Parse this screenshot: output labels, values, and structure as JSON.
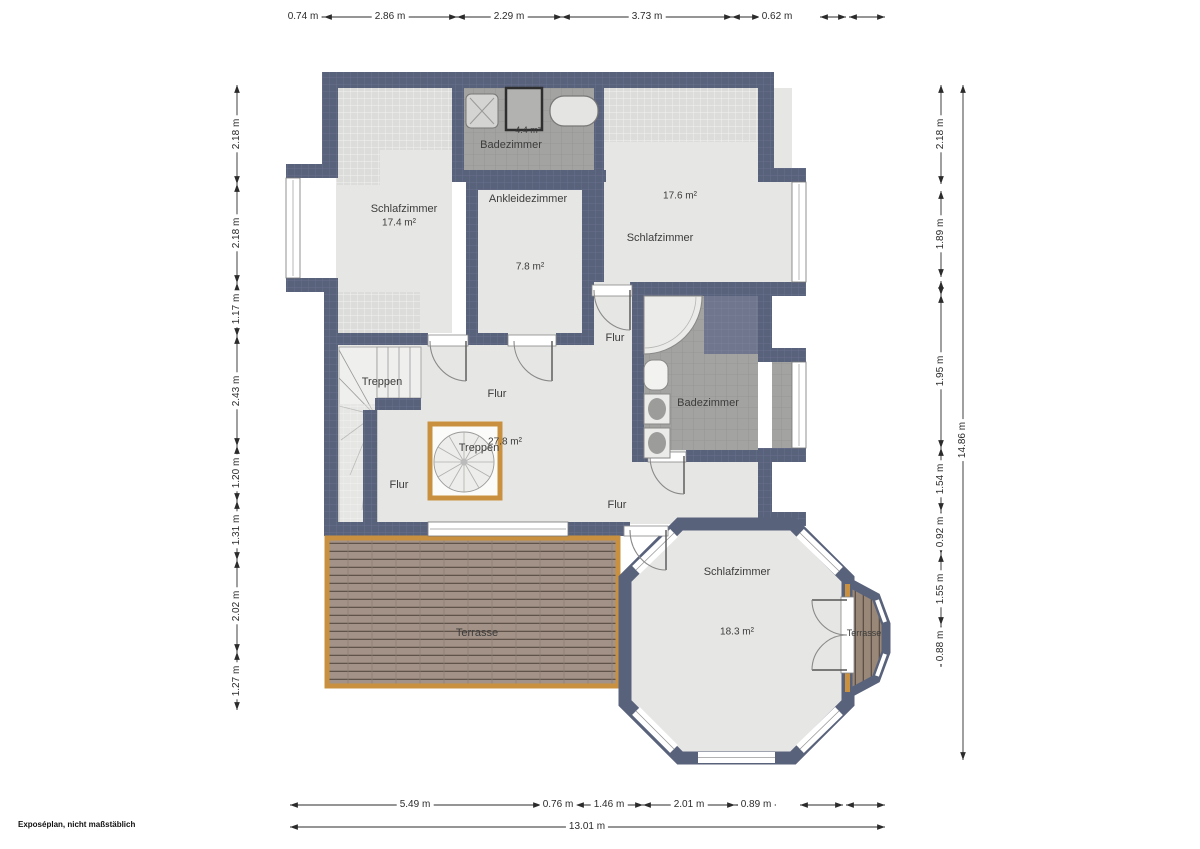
{
  "footer": {
    "note": "Exposéplan, nicht maßstäblich"
  },
  "dimensions": {
    "top": [
      "0.74 m",
      "2.86 m",
      "2.29 m",
      "3.73 m",
      "0.62 m"
    ],
    "bottom": [
      "5.49 m",
      "0.76 m",
      "1.46 m",
      "2.01 m",
      "0.89 m"
    ],
    "bottom_total": "13.01 m",
    "left": [
      "2.18 m",
      "2.18 m",
      "1.17 m",
      "2.43 m",
      "1.20 m",
      "1.31 m",
      "2.02 m",
      "1.27 m"
    ],
    "right": [
      "2.18 m",
      "1.89 m",
      "1.95 m",
      "1.54 m",
      "0.92 m",
      "1.55 m",
      "0.88 m"
    ],
    "right_total": "14.86 m"
  },
  "rooms": {
    "schlafzimmer_nw": {
      "name": "Schlafzimmer",
      "area": "17.4 m²"
    },
    "badezimmer_top": {
      "name": "Badezimmer",
      "area": "4.4 m²"
    },
    "ankleidezimmer": {
      "name": "Ankleidezimmer",
      "area": "7.8 m²"
    },
    "schlafzimmer_ne": {
      "name": "Schlafzimmer",
      "area": "17.6 m²"
    },
    "badezimmer_ost": {
      "name": "Badezimmer"
    },
    "flur": {
      "name": "Flur",
      "area": "27.8 m²"
    },
    "treppen": {
      "name": "Treppen"
    },
    "terrasse": {
      "name": "Terrasse"
    },
    "schlafzimmer_sued": {
      "name": "Schlafzimmer",
      "area": "18.3 m²"
    },
    "terrasse_ost": {
      "name": "Terrasse"
    }
  }
}
